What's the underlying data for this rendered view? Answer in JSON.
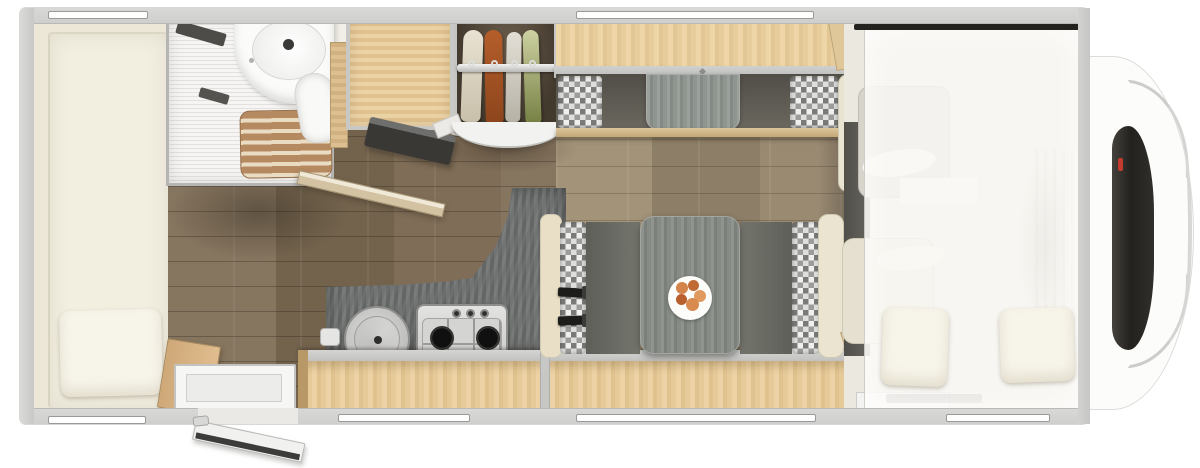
{
  "scene": {
    "type": "floorplan-top-view",
    "subject": "motorhome-interior",
    "background": "#ffffff"
  },
  "palette": {
    "body": "#f1efe8",
    "wall": "#cfcfcd",
    "bed": "#f2eee0",
    "pillow": "#f7f4ea",
    "floorDark": "#7e6e5f",
    "floorLight": "#9a8c7c",
    "woodLight": "#e6cb99",
    "woodMid": "#dfc28e",
    "woodDark": "#b99868",
    "counter": "#6c6f6e",
    "seatGray": "#66675f",
    "tableGray": "#868b86",
    "checkerLight": "#f0f0ee",
    "checkerDark": "#7a7a78",
    "duckboard": "#b68a60",
    "clothCream": "#e9e2d2",
    "clothOrange": "#b55e2b",
    "clothGreen": "#768043",
    "overlay": "rgba(250,249,245,0.82)",
    "windshield": "#23211e",
    "accentRed": "#c23b2e"
  },
  "objects": [
    "rear-bed",
    "bed-pillow",
    "bathroom-shower",
    "bathroom-vanity",
    "toilet",
    "shower-duckboard",
    "bathroom-door",
    "entry-door",
    "entry-step",
    "kitchen-counter",
    "round-sink",
    "gas-hob-three-burner",
    "lower-sideboard",
    "fridge-cabinet",
    "wall-tv",
    "wardrobe",
    "hanging-clothes-four",
    "overhead-locker",
    "rear-lounge-sofa",
    "dinette-bench-left",
    "dinette-bench-right",
    "dinette-table",
    "plate-of-food",
    "seat-belts",
    "cab-seat-upper",
    "cab-seat-lower",
    "drop-down-bed",
    "cab-pillows",
    "vehicle-nose",
    "windshield"
  ],
  "counts": {
    "roof-windows": 6,
    "hanging-garments": 4,
    "hob-burners": 3,
    "pillows-cab-bed": 2
  }
}
